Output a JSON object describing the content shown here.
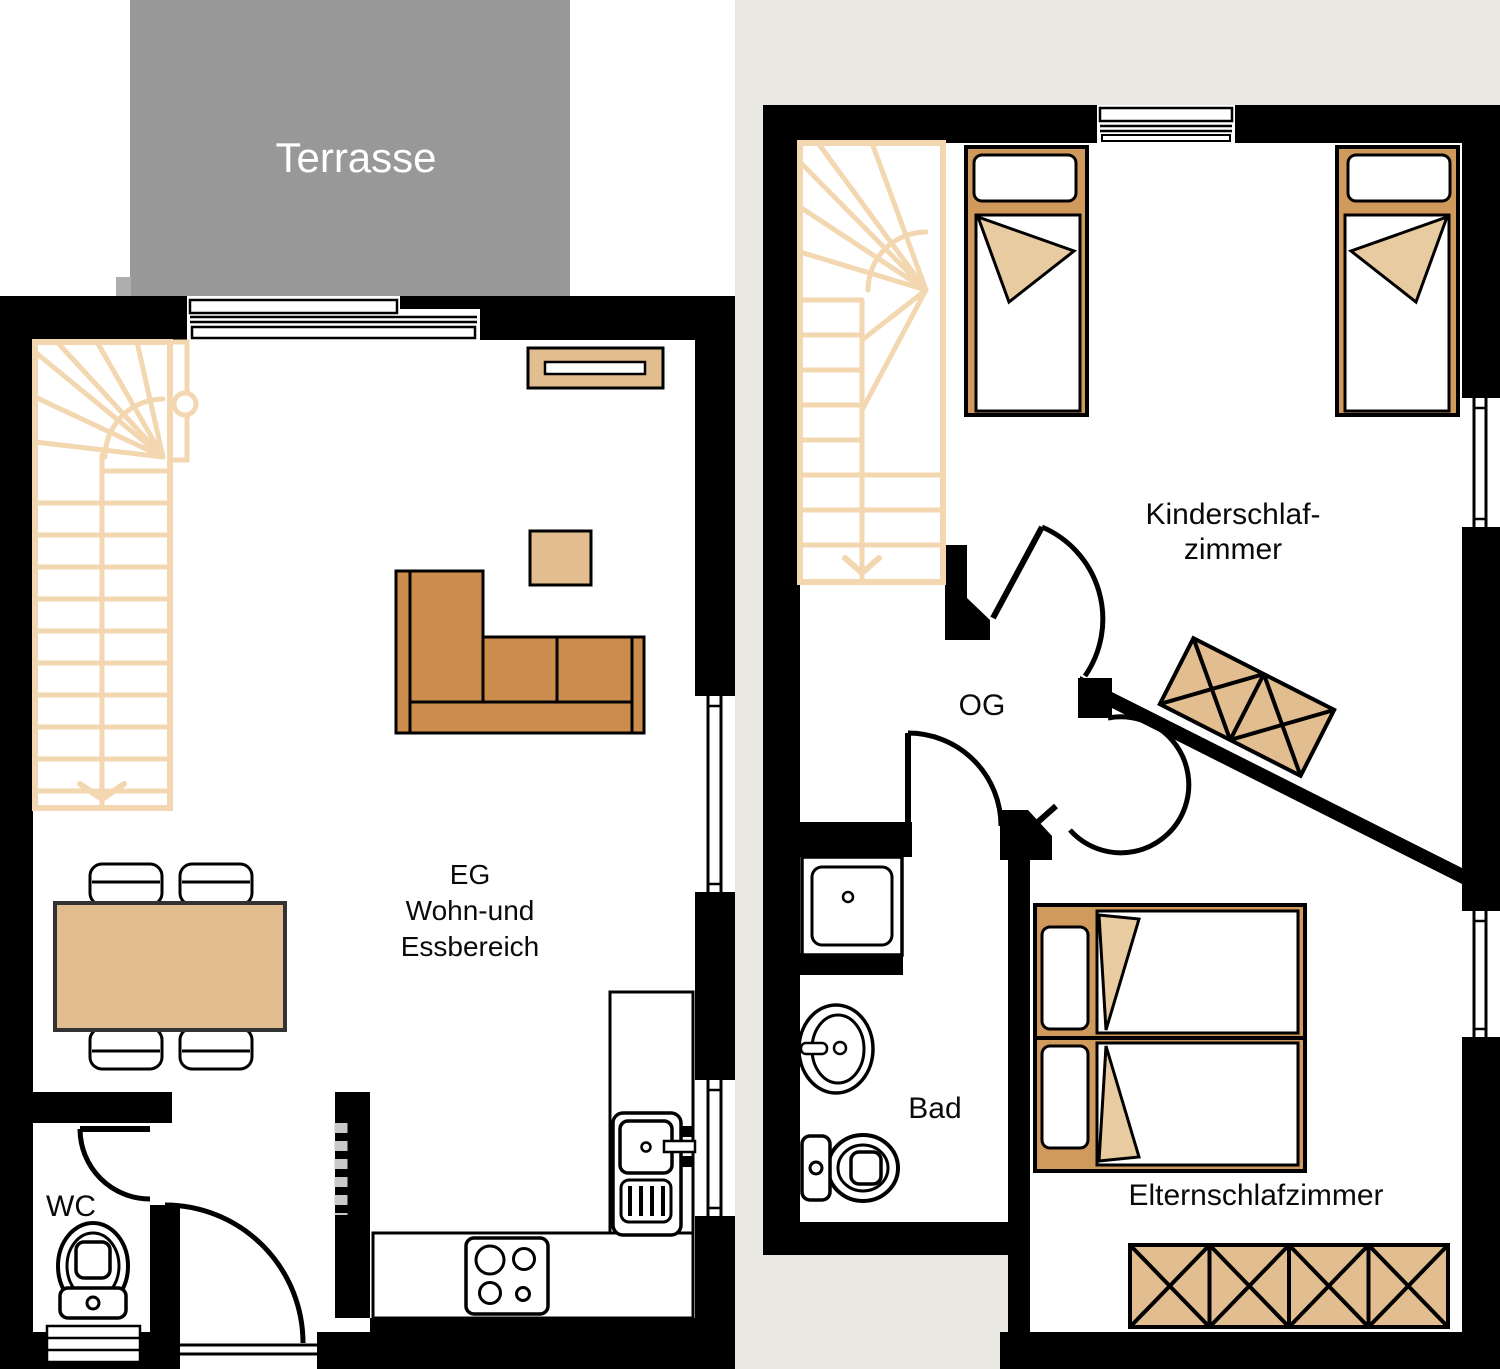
{
  "page": {
    "type": "floor-plan",
    "background_left_panel": "#ffffff",
    "background_right_panel": "#e9e8e2"
  },
  "labels": {
    "terrace": "Terrasse",
    "eg_line1": "EG",
    "eg_line2": "Wohn-und",
    "eg_line3": "Essbereich",
    "wc": "WC",
    "children_room_line1": "Kinderschlaf-",
    "children_room_line2": "zimmer",
    "og": "OG",
    "bathroom": "Bad",
    "parents_room": "Elternschlafzimmer"
  },
  "colors": {
    "wall": "#000000",
    "terrace": "#989898",
    "terrace_step": "#aeaeae",
    "terrace_label": "#ffffff",
    "stair": "#f3d7b0",
    "furniture_light": "#e2bd90",
    "bed_frame": "#d09a5c",
    "sofa": "#cc8c4e",
    "blanket_fold": "#e9cba1",
    "dashed_marker": "#c9c9c9",
    "room_text": "#0a0a0a",
    "interior": "#ffffff"
  }
}
